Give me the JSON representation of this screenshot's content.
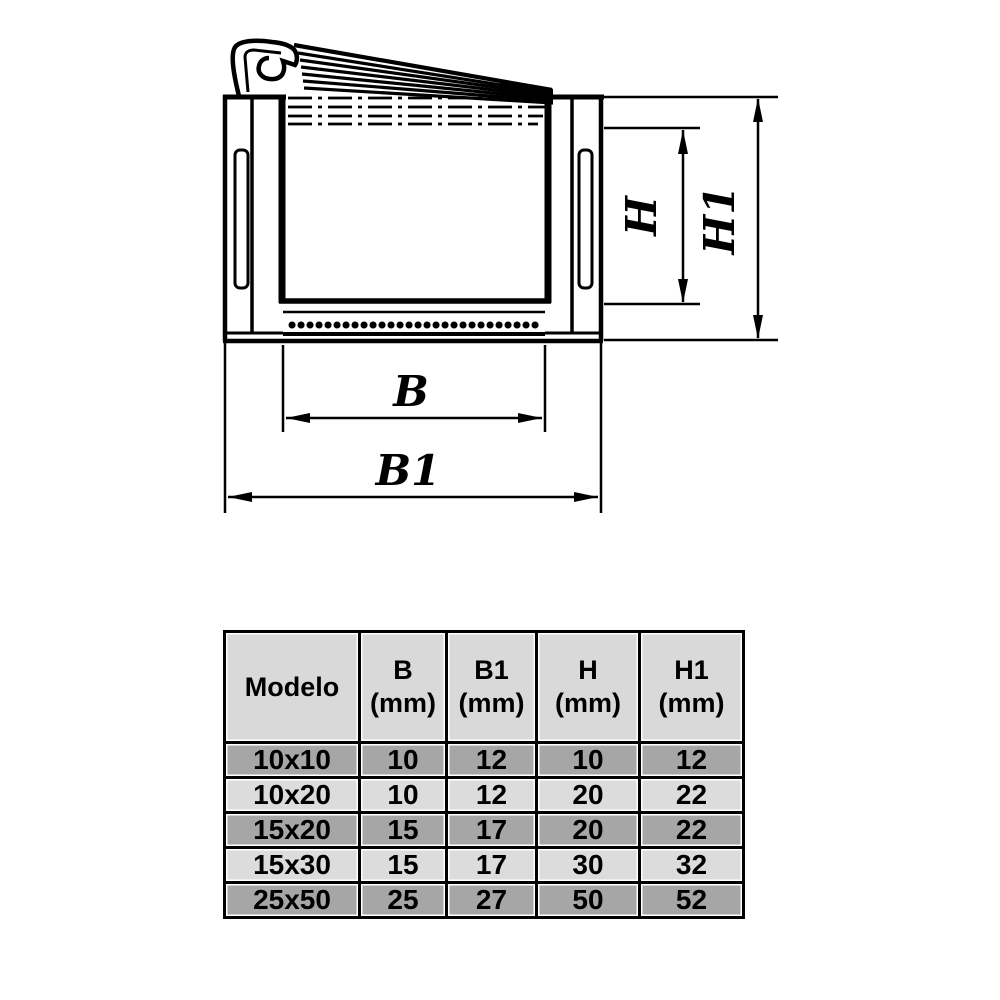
{
  "diagram": {
    "labels": {
      "b": "B",
      "b1": "B1",
      "h": "H",
      "h1": "H1"
    }
  },
  "table": {
    "header": {
      "col0": "Modelo",
      "col1_label": "B",
      "col1_unit": "(mm)",
      "col2_label": "B1",
      "col2_unit": "(mm)",
      "col3_label": "H",
      "col3_unit": "(mm)",
      "col4_label": "H1",
      "col4_unit": "(mm)"
    },
    "rows": [
      [
        "10x10",
        "10",
        "12",
        "10",
        "12"
      ],
      [
        "10x20",
        "10",
        "12",
        "20",
        "22"
      ],
      [
        "15x20",
        "15",
        "17",
        "20",
        "22"
      ],
      [
        "15x30",
        "15",
        "17",
        "30",
        "32"
      ],
      [
        "25x50",
        "25",
        "27",
        "50",
        "52"
      ]
    ]
  },
  "colors": {
    "line": "#000000",
    "row_dark": "#a6a6a6",
    "row_light": "#dcdcdc",
    "header_bg": "#d9d9d9",
    "muted_text": "#3d3d3d"
  },
  "chart_data": {
    "type": "table",
    "title": "Canaleta profile dimensions",
    "columns": [
      "Modelo",
      "B (mm)",
      "B1 (mm)",
      "H (mm)",
      "H1 (mm)"
    ],
    "rows": [
      [
        "10x10",
        10,
        12,
        10,
        12
      ],
      [
        "10x20",
        10,
        12,
        20,
        22
      ],
      [
        "15x20",
        15,
        17,
        20,
        22
      ],
      [
        "15x30",
        15,
        17,
        30,
        32
      ],
      [
        "25x50",
        25,
        27,
        50,
        52
      ]
    ]
  }
}
